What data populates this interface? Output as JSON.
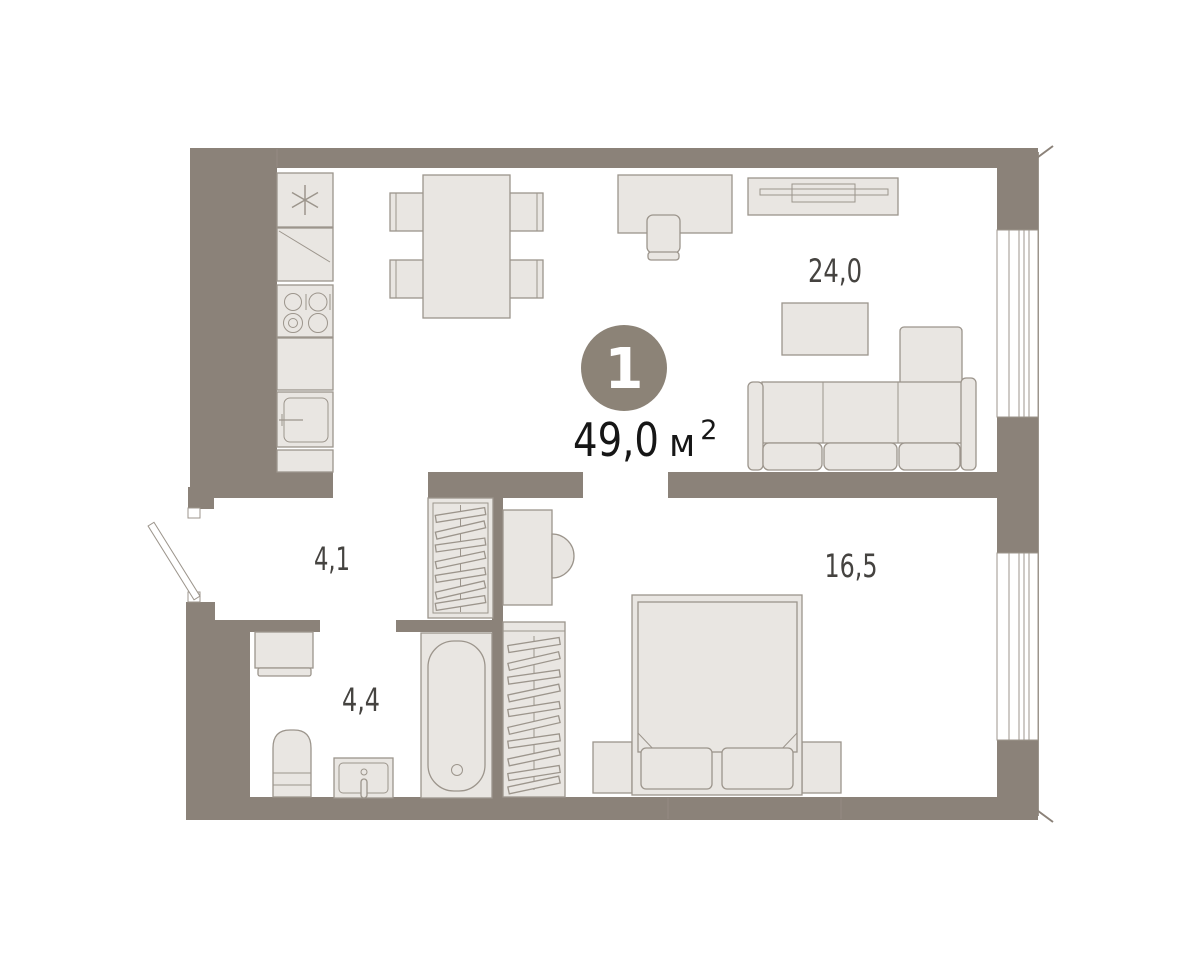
{
  "apartment_card": {
    "rooms_count": "1",
    "total_area_value": "49,0",
    "total_area_unit": "м",
    "total_area_sup": "2"
  },
  "room_areas": {
    "living_kitchen": "24,0",
    "hallway": "4,1",
    "bathroom": "4,4",
    "bedroom": "16,5"
  },
  "colors": {
    "wall": "#8b8279",
    "furniture_fill": "#e9e6e2",
    "furniture_stroke": "#9c958c",
    "badge": "#8c8377",
    "room_label_text": "#454340",
    "total_area_text": "#161616",
    "background": "#ffffff"
  }
}
